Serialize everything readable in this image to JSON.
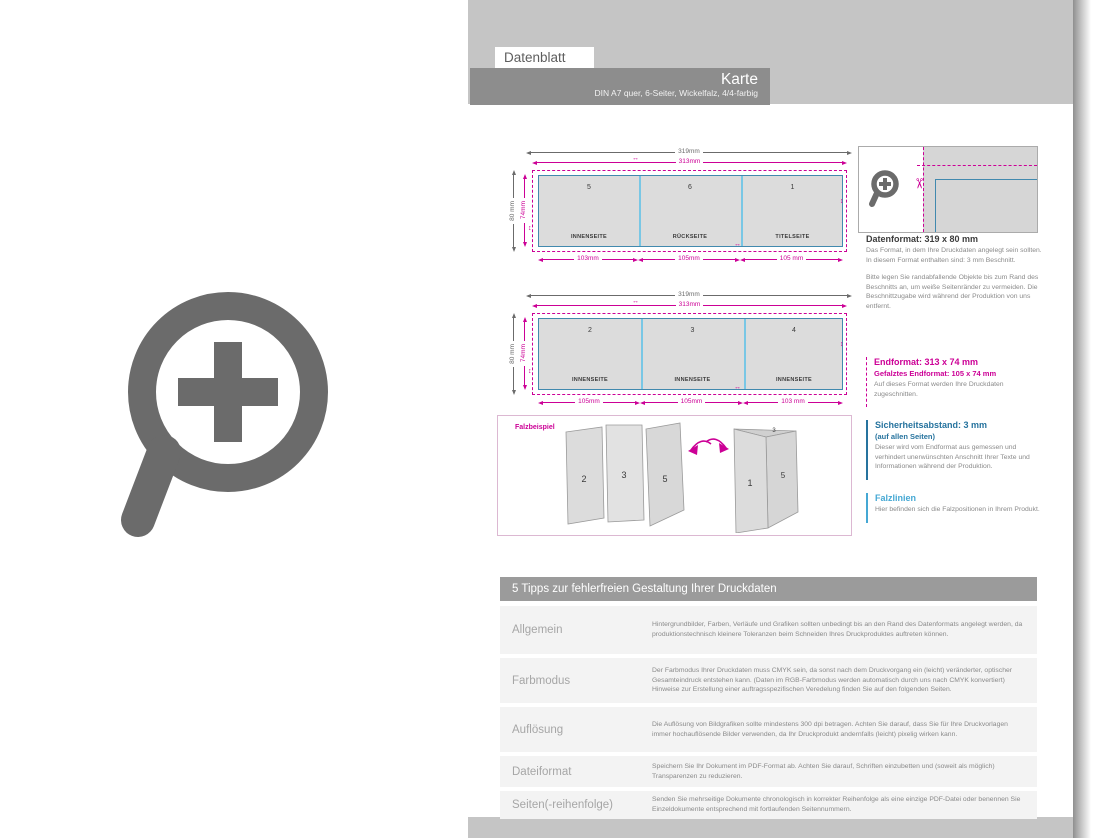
{
  "header": {
    "tab": "Datenblatt",
    "title": "Karte",
    "subtitle": "DIN A7 quer, 6-Seiter, Wickelfalz, 4/4-farbig"
  },
  "diagram1": {
    "outer_width": "319mm",
    "inner_width": "313mm",
    "outer_height": "80 mm",
    "inner_height": "74mm",
    "panels": [
      {
        "num": "5",
        "label": "INNENSEITE",
        "width": "103mm"
      },
      {
        "num": "6",
        "label": "RÜCKSEITE",
        "width": "105mm"
      },
      {
        "num": "1",
        "label": "TITELSEITE",
        "width": "105 mm"
      }
    ]
  },
  "diagram2": {
    "outer_width": "319mm",
    "inner_width": "313mm",
    "outer_height": "80 mm",
    "inner_height": "74mm",
    "panels": [
      {
        "num": "2",
        "label": "INNENSEITE",
        "width": "105mm"
      },
      {
        "num": "3",
        "label": "INNENSEITE",
        "width": "105mm"
      },
      {
        "num": "4",
        "label": "INNENSEITE",
        "width": "103 mm"
      }
    ]
  },
  "fold_example": {
    "label": "Falzbeispiel",
    "left_card": {
      "panel1": "2",
      "panel2": "3",
      "panel3": "5"
    },
    "right_card": {
      "top": "3",
      "front": "1",
      "side": "5"
    }
  },
  "sidebar": {
    "datenformat": {
      "heading": "Datenformat: 319 x 80 mm",
      "para1": "Das Format, in dem Ihre Druckdaten angelegt sein sollten. In diesem Format enthalten sind: 3 mm Beschnitt.",
      "para2": "Bitte legen Sie randabfallende Objekte bis zum Rand des Beschnitts an, um weiße Seitenränder zu vermeiden. Die Beschnittzugabe wird während der Produktion von uns entfernt."
    },
    "endformat": {
      "heading": "Endformat: 313 x 74 mm",
      "subheading": "Gefalztes Endformat: 105 x 74 mm",
      "para": "Auf dieses Format werden Ihre Druckdaten zugeschnitten."
    },
    "sicherheitsabstand": {
      "heading": "Sicherheitsabstand: 3 mm",
      "subheading": "(auf allen Seiten)",
      "para": "Dieser wird vom Endformat aus gemessen und verhindert unerwünschten Anschnitt Ihrer Texte und Informationen während der Produktion."
    },
    "falzlinien": {
      "heading": "Falzlinien",
      "para": "Hier befinden sich die Falzpositionen in Ihrem Produkt."
    }
  },
  "tips": {
    "title": "5 Tipps zur fehlerfreien Gestaltung Ihrer Druckdaten",
    "rows": [
      {
        "label": "Allgemein",
        "text": "Hintergrundbilder, Farben, Verläufe und Grafiken sollten unbedingt bis an den Rand des Datenformats angelegt werden, da produktionstechnisch kleinere Toleranzen beim Schneiden Ihres Druckproduktes auftreten können."
      },
      {
        "label": "Farbmodus",
        "text": "Der Farbmodus Ihrer Druckdaten muss CMYK sein, da sonst nach dem Druckvorgang ein (leicht) veränderter, optischer Gesamteindruck entstehen kann. (Daten im RGB-Farbmodus werden automatisch durch uns nach CMYK konvertiert) Hinweise zur Erstellung einer auftragsspezifischen Veredelung finden Sie auf den folgenden Seiten."
      },
      {
        "label": "Auflösung",
        "text": "Die Auflösung von Bildgrafiken sollte mindestens 300 dpi betragen. Achten Sie darauf, dass Sie für Ihre Druckvorlagen immer hochauflösende Bilder verwenden, da Ihr Druckprodukt andernfalls (leicht) pixelig wirken kann."
      },
      {
        "label": "Dateiformat",
        "text": "Speichern Sie Ihr Dokument im PDF-Format ab. Achten Sie darauf, Schriften einzubetten und (soweit als möglich) Transparenzen zu reduzieren."
      },
      {
        "label": "Seiten(-reihenfolge)",
        "text": "Senden Sie mehrseitige Dokumente chronologisch in korrekter Reihenfolge als eine einzige PDF-Datei oder benennen Sie Einzeldokumente entsprechend mit fortlaufenden Seitennummern."
      }
    ]
  },
  "colors": {
    "accent_magenta": "#cc0096",
    "endformat_blue": "#4189ae",
    "fold_cyan": "#79c7e5",
    "safety_blue": "#26739e",
    "falzlinien_cyan": "#45a8d4",
    "band_gray": "#c5c5c5",
    "title_bar_gray": "#8d8d8d",
    "icon_gray": "#6b6b6b"
  }
}
